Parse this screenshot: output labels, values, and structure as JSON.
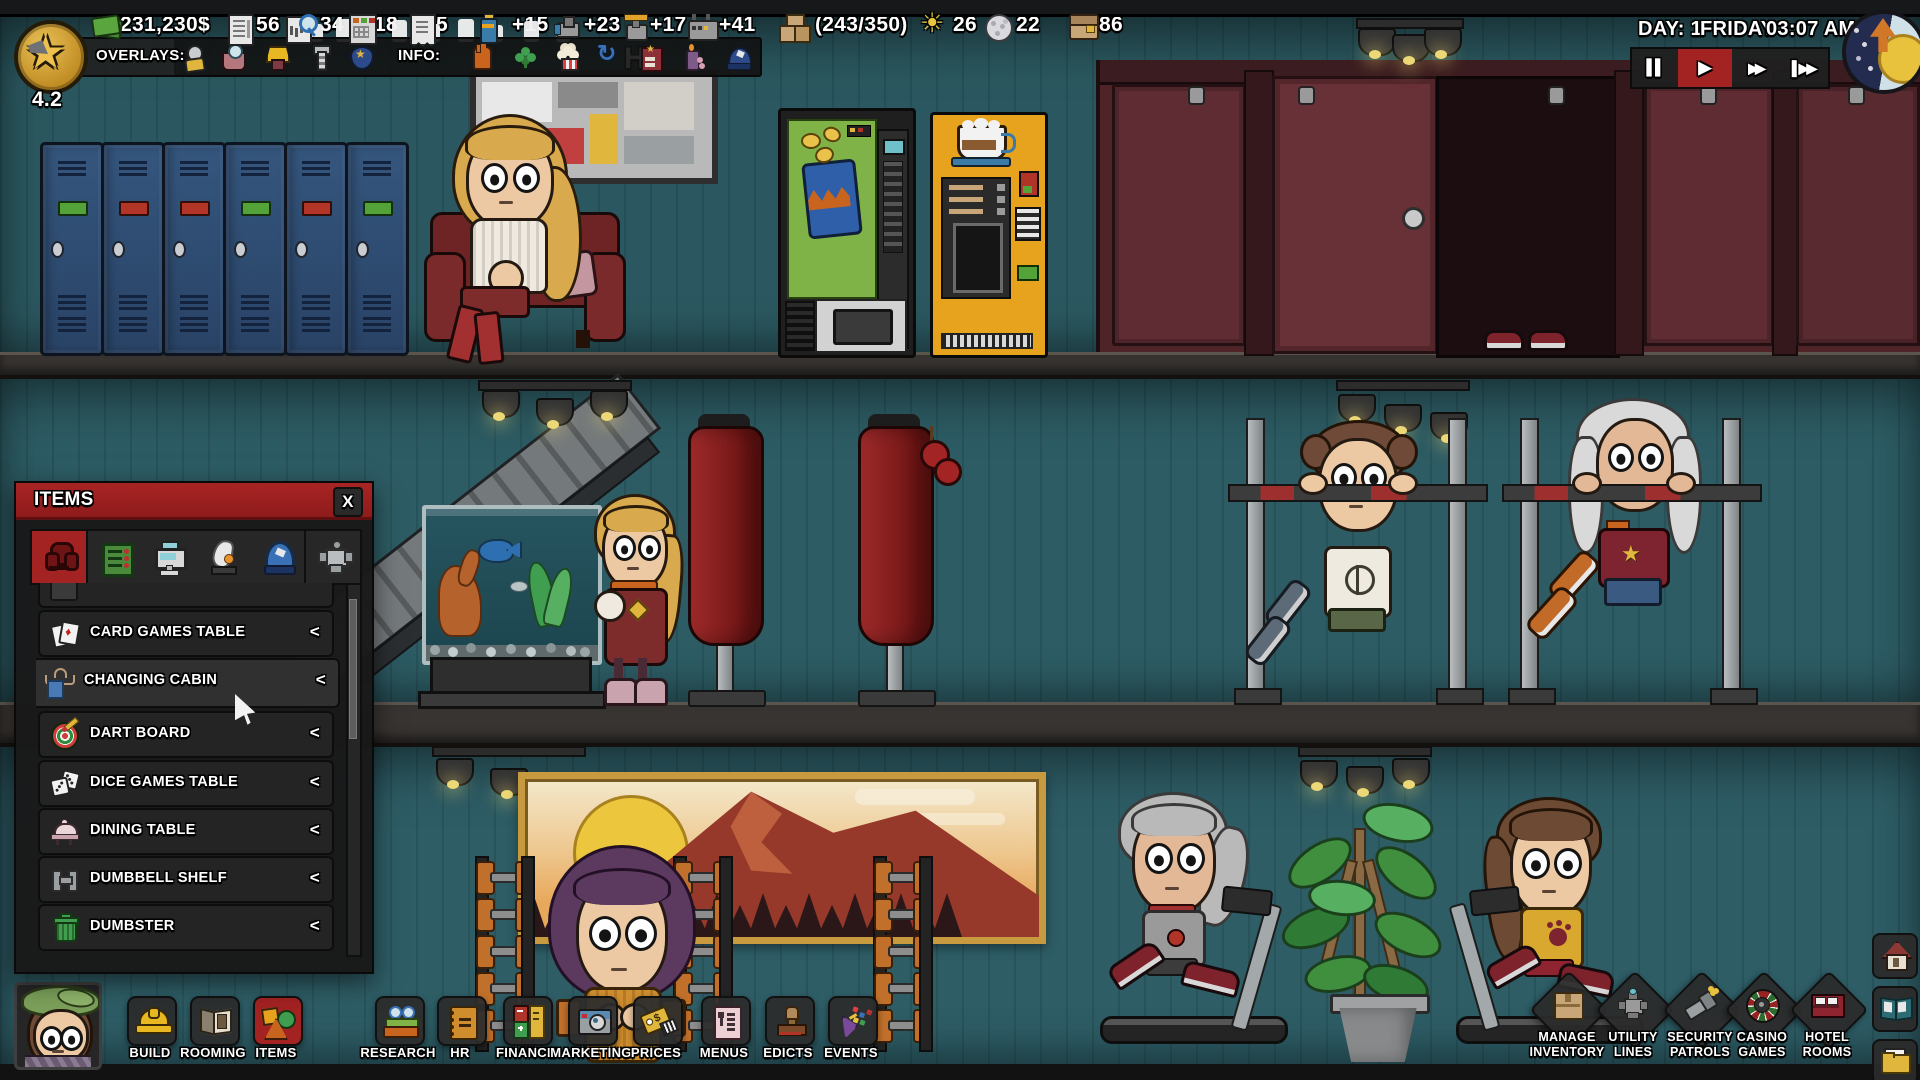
{
  "hud": {
    "level": "4.2",
    "resources": [
      {
        "icon": "cash-icon",
        "value": "231,230$"
      },
      {
        "icon": "contracts-icon",
        "value": "56"
      },
      {
        "icon": "research-points-icon",
        "value": "34"
      },
      {
        "icon": "accounting-icon",
        "value": "18"
      },
      {
        "icon": "receipts-icon",
        "value": "5"
      },
      {
        "icon": "power-icon",
        "value": "+15"
      },
      {
        "icon": "water-icon",
        "value": "+23"
      },
      {
        "icon": "gas-icon",
        "value": "+17"
      },
      {
        "icon": "ventilation-icon",
        "value": "+41"
      },
      {
        "icon": "storage-crate-icon",
        "value": "(243/350)"
      },
      {
        "icon": "sun-guests-icon",
        "value": "26"
      },
      {
        "icon": "moon-guests-icon",
        "value": "22"
      },
      {
        "icon": "wallet-icon",
        "value": "86"
      }
    ],
    "overlays": {
      "label": "OVERLAYS:",
      "icons": [
        "guest-overlay-icon",
        "hygiene-overlay-icon",
        "comfort-overlay-icon",
        "maintenance-overlay-icon",
        "security-overlay-icon"
      ]
    },
    "info": {
      "label": "INFO:",
      "icons": [
        "service-info-icon",
        "luck-info-icon",
        "snacks-info-icon",
        "cycle-info-icon",
        "hotel-info-icon",
        "ambience-info-icon",
        "staff-info-icon"
      ]
    },
    "clock": {
      "day": "DAY: 1",
      "weekday": "FRIDAY",
      "time": "03:07 AM"
    },
    "speed": {
      "pause": "▌▌",
      "play": "▶",
      "fast": "▶▶",
      "fastest": "▌▶▶"
    }
  },
  "items_panel": {
    "title": "ITEMS",
    "close": "X",
    "tabs": [
      "furniture-tab-icon",
      "electronics-tab-icon",
      "registers-tab-icon",
      "ambience-tab-icon",
      "clothing-tab-icon",
      "gadgets-tab-icon"
    ],
    "rows": [
      {
        "icon": "card-games-icon",
        "label": "CARD GAMES TABLE",
        "chevron": "<"
      },
      {
        "icon": "changing-cabin-icon",
        "label": "CHANGING CABIN",
        "chevron": "<"
      },
      {
        "icon": "dart-board-icon",
        "label": "DART BOARD",
        "chevron": "<"
      },
      {
        "icon": "dice-games-icon",
        "label": "DICE GAMES TABLE",
        "chevron": "<"
      },
      {
        "icon": "dining-table-icon",
        "label": "DINING TABLE",
        "chevron": "<"
      },
      {
        "icon": "dumbbell-shelf-icon",
        "label": "DUMBBELL SHELF",
        "chevron": "<"
      },
      {
        "icon": "dumbster-icon",
        "label": "DUMBSTER",
        "chevron": "<"
      }
    ]
  },
  "toolbar": {
    "buttons": [
      {
        "label": "BUILD",
        "icon": "hardhat-icon"
      },
      {
        "label": "ROOMING",
        "icon": "room-box-icon"
      },
      {
        "label": "ITEMS",
        "icon": "shapes-icon"
      },
      {
        "label": "RESEARCH",
        "icon": "books-icon"
      },
      {
        "label": "HR",
        "icon": "notebook-icon"
      },
      {
        "label": "FINANCE",
        "icon": "ledgers-icon"
      },
      {
        "label": "MARKETING",
        "icon": "camera-icon"
      },
      {
        "label": "PRICES",
        "icon": "price-tag-icon"
      },
      {
        "label": "MENUS",
        "icon": "menu-card-icon"
      },
      {
        "label": "EDICTS",
        "icon": "stamp-icon"
      },
      {
        "label": "EVENTS",
        "icon": "party-popper-icon"
      }
    ]
  },
  "right_panel": {
    "buttons": [
      {
        "line1": "MANAGE",
        "line2": "INVENTORY",
        "icon": "inventory-crate-icon"
      },
      {
        "line1": "UTILITY",
        "line2": "LINES",
        "icon": "utility-valve-icon"
      },
      {
        "line1": "SECURITY",
        "line2": "PATROLS",
        "icon": "flashlight-icon"
      },
      {
        "line1": "CASINO",
        "line2": "GAMES",
        "icon": "roulette-icon"
      },
      {
        "line1": "HOTEL",
        "line2": "ROOMS",
        "icon": "hotel-bed-icon"
      }
    ],
    "side": [
      {
        "icon": "home-icon"
      },
      {
        "icon": "guide-book-icon"
      },
      {
        "icon": "documents-folder-icon"
      }
    ]
  },
  "scene": {
    "wall_color": "#2d5c64",
    "accent_red": "#a32222",
    "objects": [
      "lockers",
      "sofa",
      "wall-art",
      "snack-vending-machine",
      "coffee-vending-machine",
      "toilet-stalls",
      "aquarium",
      "punching-bags",
      "pull-up-bars",
      "escalator",
      "landscape-painting",
      "dumbbell-racks",
      "treadmills",
      "potted-plant"
    ],
    "characters": [
      "guest-on-sofa",
      "guest-walking",
      "guest-pull-up-1",
      "guest-pull-up-2",
      "guest-treadmill-1",
      "guest-treadmill-2",
      "guest-lifting-weights",
      "guest-feet-in-stall"
    ]
  }
}
